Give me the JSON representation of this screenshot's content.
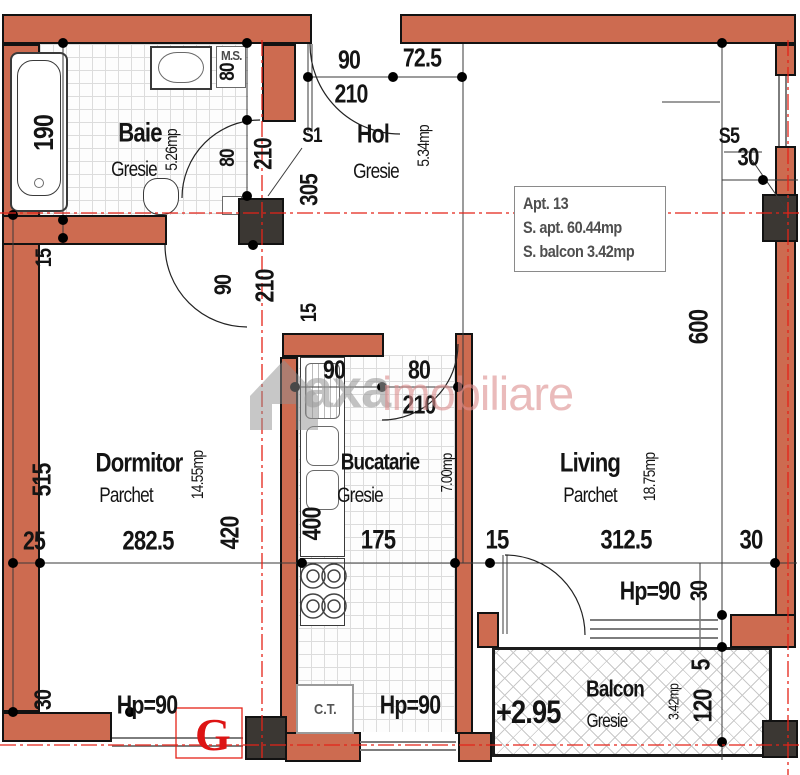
{
  "info_box": {
    "line1": "Apt.  13",
    "line2": "S. apt. 60.44mp",
    "line3": "S. balcon 3.42mp"
  },
  "watermark": {
    "part1": "axa",
    "part2": "imobiliare"
  },
  "rooms": [
    {
      "name": "Baie",
      "floor": "Gresie",
      "area": "5.26mp"
    },
    {
      "name": "Hol",
      "floor": "Gresie",
      "area": "5.34mp"
    },
    {
      "name": "Dormitor",
      "floor": "Parchet",
      "area": "14.55mp"
    },
    {
      "name": "Bucatarie",
      "floor": "Gresie",
      "area": "7.00mp"
    },
    {
      "name": "Living",
      "floor": "Parchet",
      "area": "18.75mp"
    },
    {
      "name": "Balcon",
      "floor": "Gresie",
      "area": "3.42mp",
      "level": "+2.95"
    }
  ],
  "labels": {
    "ms": "M.S.",
    "ct": "C.T.",
    "g": "G"
  },
  "dims": {
    "v190": "190",
    "n80a": "80",
    "n80b": "80",
    "v210a": "210",
    "e90": "90",
    "e725": "72.5",
    "e210": "210",
    "s1": "S1",
    "v305": "305",
    "s5": "S5",
    "tr30": "30",
    "v600": "600",
    "l15": "15",
    "bd90": "90",
    "bd210": "210",
    "m15": "15",
    "k90": "90",
    "k80": "80",
    "k210": "210",
    "v515": "515",
    "h25": "25",
    "h2825": "282.5",
    "v420": "420",
    "v400": "400",
    "h175": "175",
    "h15": "15",
    "h3125": "312.5",
    "h30": "30",
    "hp90_living": "Hp=90",
    "rv30": "30",
    "bl30": "30",
    "hp90_left": "Hp=90",
    "hp90_kitchen": "Hp=90",
    "v120": "120",
    "v5": "5"
  },
  "colors": {
    "wall": "#cd6b50",
    "column": "#3b3733",
    "centerline": "#e42318",
    "marker": "#dd1414"
  }
}
